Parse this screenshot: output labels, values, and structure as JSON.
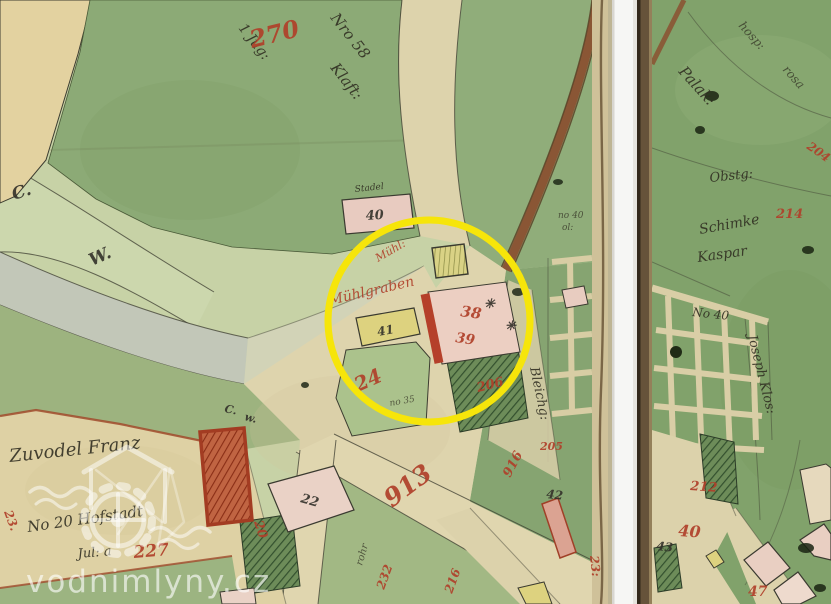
{
  "document": {
    "kind": "historical-cadastral-map-scan",
    "sheets": 2,
    "highlight": {
      "shape": "circle",
      "color": "#f6e50a"
    }
  },
  "watermark": {
    "site": "vodnimlyny.cz",
    "logo": "watermill-logo"
  },
  "colors": {
    "yellow_circle": "#f6e50a",
    "red_ink": "#b0402a",
    "black_ink": "#2e2c20",
    "field_green_dark": "#8caa76",
    "field_green_light": "#c7d2a6",
    "road_tan": "#ded4ad",
    "building_pink": "#eccfc2",
    "building_yellow": "#ddd27f",
    "building_red": "#b5402a",
    "sheet_edge_brown": "#66533a",
    "gap_white": "#f6f6f4"
  },
  "labels": {
    "red": {
      "n270": "270",
      "muhl1": "Mühl:",
      "muhl2": "Mühlgraben",
      "n24": "24",
      "n38": "38",
      "n39": "39",
      "n206": "206",
      "n205": "205",
      "n916": "916",
      "n913": "913",
      "n227": "227",
      "n20": "20",
      "n23": "23.",
      "n23b": "23:",
      "n232": "232",
      "n216": "216",
      "n214": "214",
      "n204": "204",
      "n212": "212",
      "n40": "40",
      "n47": "47"
    },
    "black": {
      "b40": "40",
      "b41": "41",
      "b22": "22",
      "b42": "42",
      "b43": "43",
      "cwC": "C.",
      "cwW": "W.",
      "cwC2": "C.",
      "cwW2": "w.",
      "no40strip": "no 40",
      "olstrip": "ol:",
      "star1": "✳",
      "star2": "✳"
    },
    "script": {
      "top1": "1 Jug:",
      "top2": "Nro 58",
      "top3": "Klaft:",
      "stadel": "Stadel",
      "scrawl1": "no 35",
      "rohr": "rohr",
      "bleich": "Bleichg:",
      "zuvodel": "Zuvodel Franz",
      "hofstadt": "No 20 Hofstadt",
      "jula": "Jul: a",
      "palak": "Palak:",
      "hosp": "hosp:",
      "rosa": "rosa",
      "obstg": "Obstg:",
      "schimke": "Schimke",
      "kaspar": "Kaspar",
      "klos": "Joseph Klos:",
      "no40grid": "No 40"
    }
  }
}
